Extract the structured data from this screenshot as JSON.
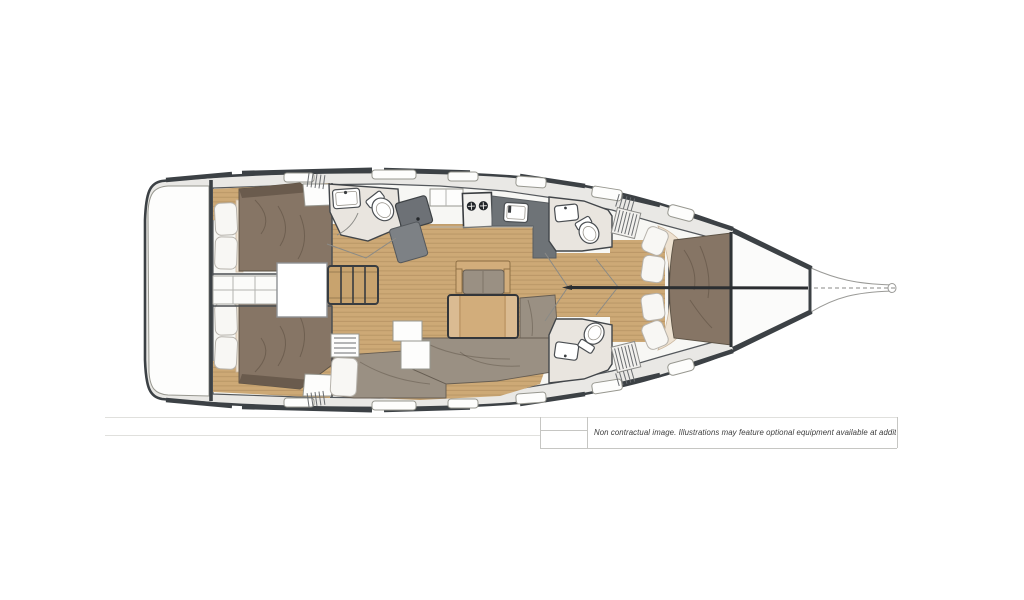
{
  "disclaimer": {
    "text": "Non contractual image. Illustrations may feature optional equipment available at additional cost."
  },
  "colors": {
    "hull_line": "#3c4145",
    "deck": "#e9e8e5",
    "interior": "#f7f7f4",
    "teak": "#cda976",
    "teak_stripe": "#a9875a",
    "bed": "#867565",
    "bed_dark": "#6a5b4d",
    "cushion": "#9a9083",
    "pillow": "#f8f7f4",
    "mattress": "#eee2d1",
    "counter": "#6e7377",
    "counter_dark": "#585d61",
    "head_floor": "#e9e5df",
    "white_fixture": "#fdfdfc",
    "line_gray": "#97978f",
    "table_wood": "#d2ad7b",
    "steps_wood": "#c8a36e",
    "faint_line": "#e0e0dd",
    "table_border": "#c6c6c3",
    "text": "#3c3c3c"
  }
}
